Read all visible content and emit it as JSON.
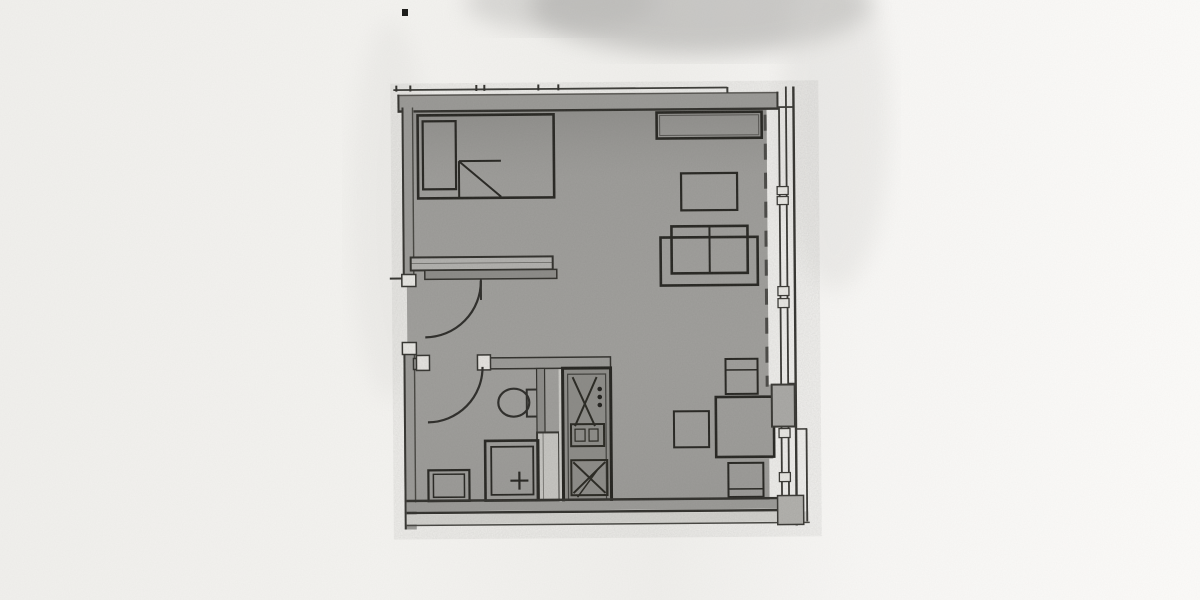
{
  "document": {
    "type": "scanned-floor-plan",
    "description": "Photocopied architectural floor plan of a studio apartment, no printed text visible",
    "visible_text": []
  },
  "colors": {
    "paper": "#f4f3f0",
    "paper_bright": "#fcfbf9",
    "scan_shadow": "#a9a8a6",
    "floor": "#a3a29f",
    "wall": "#9e9d9a",
    "line": "#2b2a27",
    "kitchen_unit": "#8f8e8a",
    "shaft": "#cbcac6",
    "ledge": "#d7d6d2",
    "pier": "#aeadaa",
    "pier2": "#b6b5b1",
    "mullion": "#efeeea",
    "shelf": "#b6b5b2",
    "divider": "#8f8e8b",
    "speck": "#1c1c1a"
  },
  "depicted_items": [
    "top-exterior-wall",
    "left-exterior-wall",
    "bottom-exterior-wall",
    "window-wall-with-mullions",
    "balcony-edge-dashed-line",
    "bed",
    "pillow",
    "blanket-fold",
    "wardrobe-shelf",
    "entry-door-swing",
    "hall-divider-wall",
    "bathroom-door-swing",
    "toilet",
    "shower",
    "washbasin",
    "service-shaft",
    "kitchenette-unit",
    "burner-dots",
    "sideboard",
    "coffee-table",
    "sofa",
    "dining-table",
    "dining-chair-north",
    "dining-chair-west",
    "dining-chair-south",
    "wall-piers",
    "scan-speck"
  ]
}
